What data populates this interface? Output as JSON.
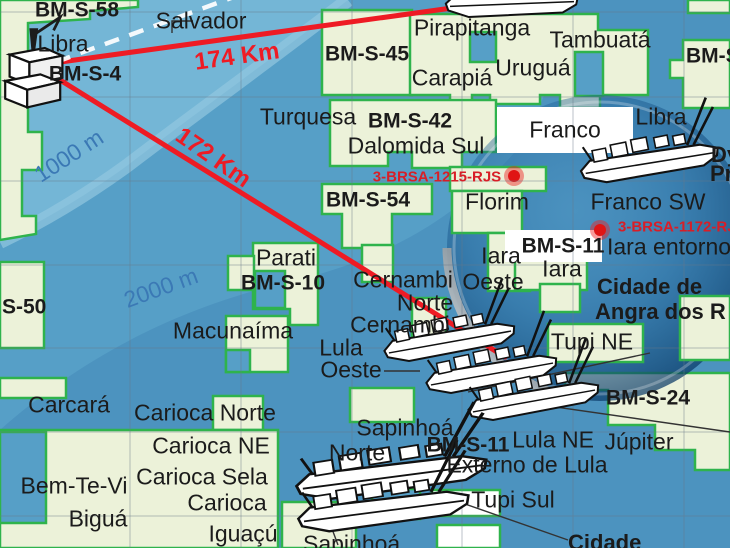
{
  "map_title": "Santos Basin pre-salt blocks and fields map",
  "colors": {
    "ocean_medium": "#569fc7",
    "ocean_shallow": "#74b6d6",
    "ocean_deep": "#4c93bf",
    "contour_band": "#93c8e0",
    "block_fill": "#ecf2d9",
    "block_border": "#2fb34c",
    "white_block": "#ffffff",
    "distance_line_red": "#ee1b24",
    "well_red": "#e02424",
    "label_black": "#1b1b1b",
    "depth_blue": "#3b79b5",
    "magnifier_blue": "#0f4f87"
  },
  "icons": [
    "oil-platform-icon",
    "fpso-vessel-icon",
    "magnifier-bubble",
    "well-marker-dot",
    "route-dashed-line"
  ],
  "distance_lines": [
    {
      "label": "174 Km",
      "from": [
        46,
        64
      ],
      "to": [
        452,
        8
      ]
    },
    {
      "label": "172 Km",
      "from": [
        44,
        70
      ],
      "to": [
        505,
        357
      ]
    }
  ],
  "well_markers": [
    {
      "label": "3-BRSA-1215-RJS",
      "x": 514,
      "y": 176
    },
    {
      "label": "3-BRSA-1172-RJ",
      "x": 600,
      "y": 230
    }
  ],
  "depth_contours": [
    "1000 m",
    "2000 m"
  ],
  "labels": [
    {
      "text": "BM-S-58",
      "type": "block",
      "x": 35,
      "y": 10,
      "align": "left"
    },
    {
      "text": "Libra",
      "type": "field",
      "x": 63,
      "y": 44
    },
    {
      "text": "BM-S-4",
      "type": "block",
      "x": 85,
      "y": 74
    },
    {
      "text": "Salvador",
      "type": "field",
      "x": 201,
      "y": 21
    },
    {
      "text": "174 Km",
      "type": "distance",
      "x": 237,
      "y": 57,
      "rot": -8
    },
    {
      "text": "172 Km",
      "type": "distance",
      "x": 213,
      "y": 158,
      "rot": 35
    },
    {
      "text": "1000 m",
      "type": "depth",
      "x": 69,
      "y": 156,
      "rot": -33
    },
    {
      "text": "2000 m",
      "type": "depth",
      "x": 161,
      "y": 288,
      "rot": -20
    },
    {
      "text": "Pirapitanga",
      "type": "field",
      "x": 472,
      "y": 28
    },
    {
      "text": "BM-S-45",
      "type": "block",
      "x": 367,
      "y": 54
    },
    {
      "text": "Carapiá",
      "type": "field",
      "x": 452,
      "y": 78
    },
    {
      "text": "Uruguá",
      "type": "field",
      "x": 533,
      "y": 68
    },
    {
      "text": "Tambuatá",
      "type": "field",
      "x": 600,
      "y": 40
    },
    {
      "text": "BM-S-",
      "type": "block",
      "x": 686,
      "y": 56,
      "align": "left"
    },
    {
      "text": "Turquesa",
      "type": "field",
      "x": 308,
      "y": 117
    },
    {
      "text": "BM-S-42",
      "type": "block",
      "x": 410,
      "y": 121
    },
    {
      "text": "Dalomida Sul",
      "type": "field",
      "x": 416,
      "y": 146
    },
    {
      "text": "3-BRSA-1215-RJS",
      "type": "well",
      "x": 437,
      "y": 177
    },
    {
      "text": "BM-S-54",
      "type": "block",
      "x": 368,
      "y": 200
    },
    {
      "text": "Florim",
      "type": "field",
      "x": 497,
      "y": 202
    },
    {
      "text": "Franco",
      "type": "field",
      "x": 565,
      "y": 130
    },
    {
      "text": "Libra",
      "type": "field",
      "x": 661,
      "y": 117
    },
    {
      "text": "Dy",
      "type": "vessel",
      "x": 711,
      "y": 155,
      "align": "left"
    },
    {
      "text": "Pr",
      "type": "vessel",
      "x": 710,
      "y": 174,
      "align": "left"
    },
    {
      "text": "Franco SW",
      "type": "field",
      "x": 648,
      "y": 202
    },
    {
      "text": "3-BRSA-1172-RJ",
      "type": "well",
      "x": 618,
      "y": 227,
      "align": "left"
    },
    {
      "text": "BM-S-11",
      "type": "block",
      "x": 563,
      "y": 246
    },
    {
      "text": "Iara entorno",
      "type": "field",
      "x": 607,
      "y": 247,
      "align": "left"
    },
    {
      "text": "Iara",
      "type": "field",
      "x": 501,
      "y": 256
    },
    {
      "text": "Oeste",
      "type": "field",
      "x": 493,
      "y": 282
    },
    {
      "text": "Iara",
      "type": "field",
      "x": 562,
      "y": 269
    },
    {
      "text": "Cidade de",
      "type": "vessel",
      "x": 597,
      "y": 287,
      "align": "left"
    },
    {
      "text": "Angra dos R",
      "type": "vessel",
      "x": 595,
      "y": 312,
      "align": "left"
    },
    {
      "text": "Tupi NE",
      "type": "field",
      "x": 592,
      "y": 342
    },
    {
      "text": "BM-S-24",
      "type": "block",
      "x": 648,
      "y": 398
    },
    {
      "text": "Lula NE",
      "type": "field",
      "x": 553,
      "y": 440
    },
    {
      "text": "Júpiter",
      "type": "field",
      "x": 639,
      "y": 442
    },
    {
      "text": "Externo de Lula",
      "type": "field",
      "x": 527,
      "y": 465
    },
    {
      "text": "Tupi Sul",
      "type": "field",
      "x": 513,
      "y": 500
    },
    {
      "text": "S-50",
      "type": "block",
      "x": 2,
      "y": 307,
      "align": "left"
    },
    {
      "text": "Parati",
      "type": "field",
      "x": 286,
      "y": 258
    },
    {
      "text": "BM-S-10",
      "type": "block",
      "x": 283,
      "y": 283
    },
    {
      "text": "Macunaíma",
      "type": "field",
      "x": 233,
      "y": 331
    },
    {
      "text": "Cernambi",
      "type": "field",
      "x": 403,
      "y": 280
    },
    {
      "text": "Norte",
      "type": "field",
      "x": 425,
      "y": 303
    },
    {
      "text": "Cernambi",
      "type": "field",
      "x": 400,
      "y": 325
    },
    {
      "text": "Lula",
      "type": "field",
      "x": 341,
      "y": 348
    },
    {
      "text": "Oeste",
      "type": "field",
      "x": 351,
      "y": 370
    },
    {
      "text": "Carcará",
      "type": "field",
      "x": 69,
      "y": 405
    },
    {
      "text": "Carioca Norte",
      "type": "field",
      "x": 205,
      "y": 413
    },
    {
      "text": "Carioca NE",
      "type": "field",
      "x": 211,
      "y": 446
    },
    {
      "text": "Carioca Sela",
      "type": "field",
      "x": 202,
      "y": 477
    },
    {
      "text": "Carioca",
      "type": "field",
      "x": 227,
      "y": 503
    },
    {
      "text": "Bem-Te-Vi",
      "type": "field",
      "x": 74,
      "y": 486
    },
    {
      "text": "Biguá",
      "type": "field",
      "x": 98,
      "y": 519
    },
    {
      "text": "Iguaçú",
      "type": "field",
      "x": 243,
      "y": 534
    },
    {
      "text": "Sapinhoá",
      "type": "field",
      "x": 405,
      "y": 428
    },
    {
      "text": "Norte",
      "type": "field",
      "x": 357,
      "y": 453
    },
    {
      "text": "BM-S-11",
      "type": "block",
      "x": 468,
      "y": 445
    },
    {
      "text": "Cidade",
      "type": "vessel",
      "x": 568,
      "y": 543,
      "align": "left"
    },
    {
      "text": "Sapinhoá",
      "type": "field",
      "x": 303,
      "y": 544,
      "align": "left"
    }
  ]
}
